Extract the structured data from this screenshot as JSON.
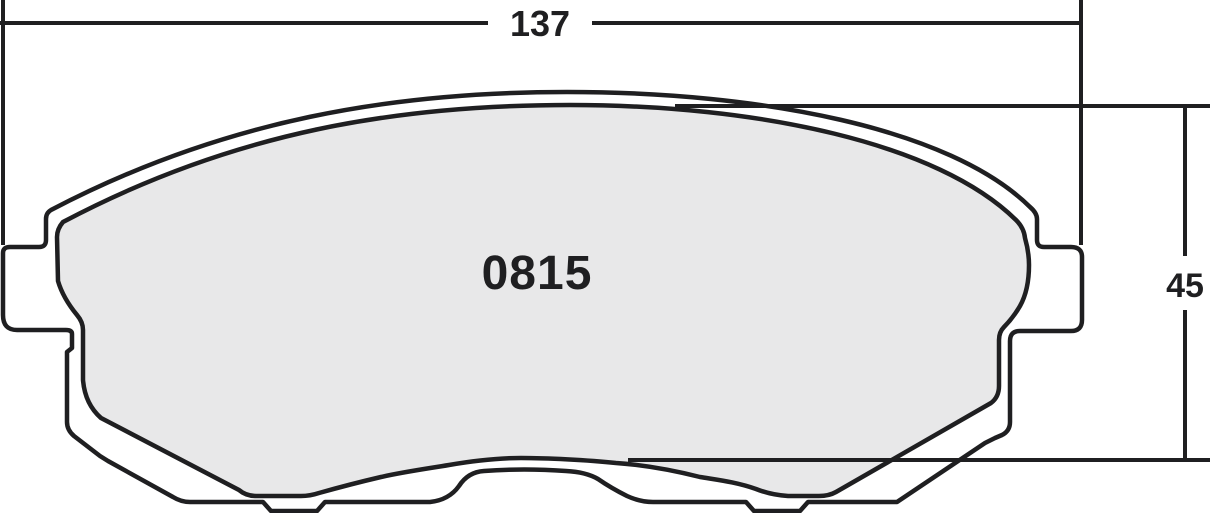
{
  "drawing": {
    "part_number": "0815",
    "width_dimension": "137",
    "height_dimension": "45",
    "colors": {
      "line": "#1f1f21",
      "friction_material_fill": "#e8e8e9",
      "backing_plate_fill": "#ffffff",
      "background": "#ffffff"
    }
  }
}
